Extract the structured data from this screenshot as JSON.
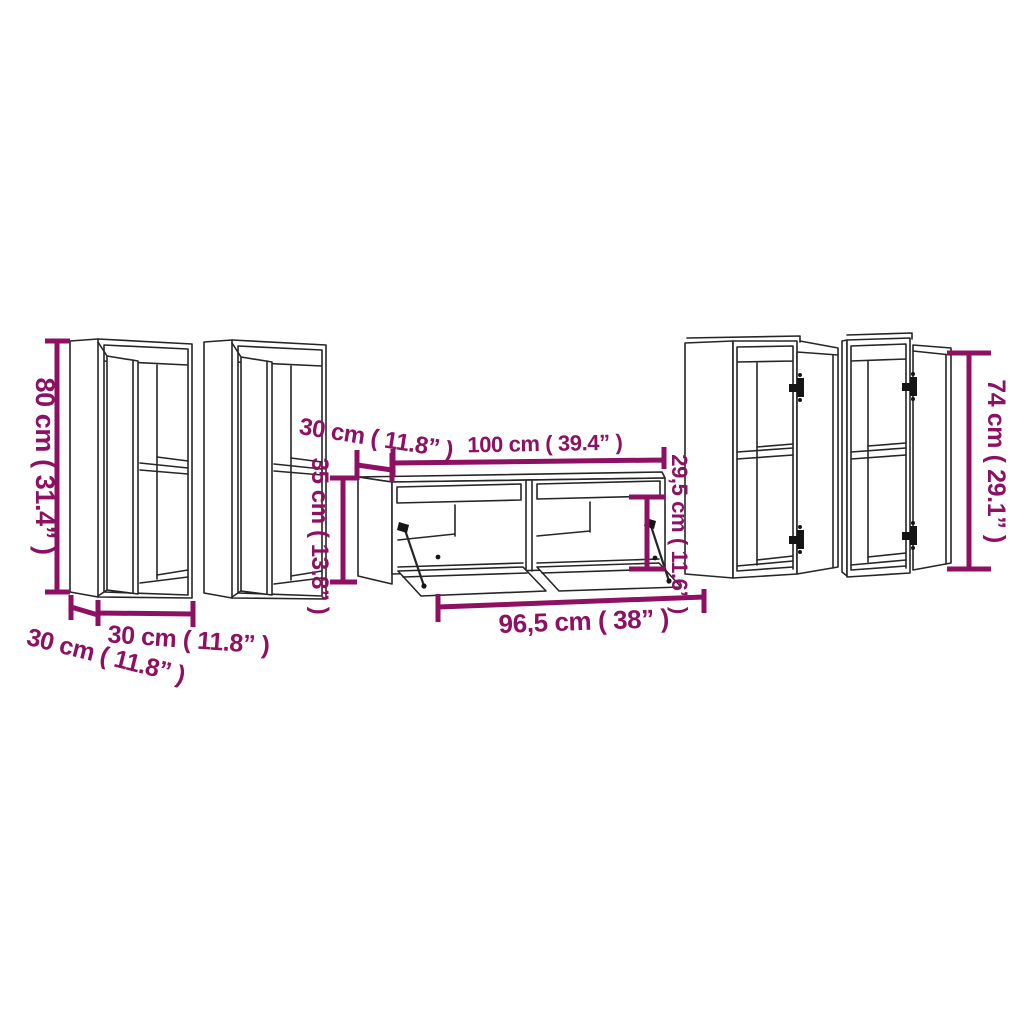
{
  "diagram": {
    "kind": "furniture-dimension-drawing",
    "pieces": [
      "wall-cabinet-left-1",
      "wall-cabinet-left-2",
      "tv-stand-center",
      "wall-cabinet-right-1",
      "wall-cabinet-right-2"
    ]
  },
  "labels": {
    "left_cabinet_height": "80 cm ( 31.4” )",
    "left_cabinet_width": "30 cm ( 11.8” )",
    "left_cabinet_depth": "30 cm ( 11.8” )",
    "tv_stand_depth": "30 cm ( 11.8” )",
    "tv_stand_height": "35 cm ( 13.8” )",
    "tv_stand_width": "100 cm ( 39.4” )",
    "tv_stand_inner_height": "29,5 cm ( 11.6” )",
    "tv_stand_inner_width": "96,5 cm ( 38” )",
    "right_cabinet_height": "74 cm ( 29.1” )"
  },
  "colors": {
    "dimension_accent": "#8E1063",
    "line_art": "#262626",
    "background": "#ffffff"
  }
}
